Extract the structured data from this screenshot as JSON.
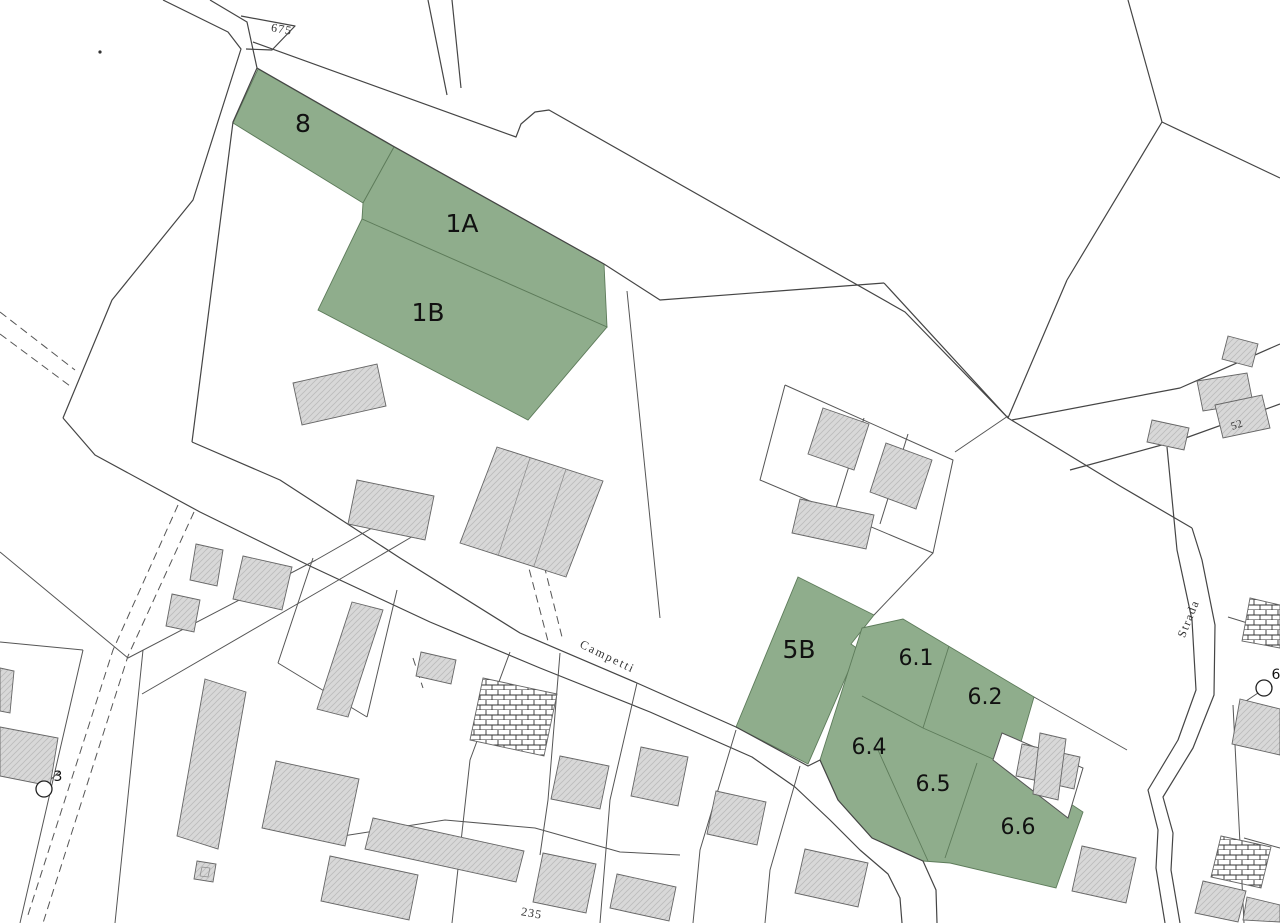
{
  "map": {
    "type": "cadastral-parcel-map",
    "background": "#ffffff",
    "colors": {
      "parcel_green": "#8FAD8C",
      "parcel_green_stroke": "#5d7b5a",
      "line": "#454545",
      "boundary": "#555555",
      "building_fill": "#d8d8d8",
      "building_hatch": "#bcbcbc",
      "building_stroke": "#666666",
      "brick_line": "#333333",
      "label": "#111111",
      "road_label": "#333333"
    },
    "green_parcels": [
      {
        "id": "8",
        "points": "233,123 258,69 394,147 363,203"
      },
      {
        "id": "1A",
        "points": "363,203 394,147 604,264 607,327 362,219"
      },
      {
        "id": "1B",
        "points": "362,219 607,327 528,420 318,310"
      },
      {
        "id": "5B",
        "points": "798,577 874,615 851,644 858,649 808,764 736,727"
      },
      {
        "id": "6-block",
        "points": "862,628 903,619 1034,697 1014,766 1021,771 1083,812 1056,888 950,863 923,861 872,838 838,800 820,760"
      }
    ],
    "cutouts": [
      {
        "id": "6-cutout",
        "points": "1002,733 1083,768 1068,818 993,760"
      }
    ],
    "green_dividers": [
      {
        "points": "949,646 923,728"
      },
      {
        "points": "862,696 923,728 993,759"
      },
      {
        "points": "878,750 928,861"
      },
      {
        "points": "977,763 945,858"
      }
    ],
    "parcel_labels": [
      {
        "text": "8",
        "x": 303,
        "y": 132,
        "fs": 25
      },
      {
        "text": "1A",
        "x": 462,
        "y": 232,
        "fs": 25
      },
      {
        "text": "1B",
        "x": 428,
        "y": 321,
        "fs": 25
      },
      {
        "text": "5B",
        "x": 799,
        "y": 658,
        "fs": 25
      },
      {
        "text": "6.1",
        "x": 916,
        "y": 665,
        "fs": 22
      },
      {
        "text": "6.2",
        "x": 985,
        "y": 704,
        "fs": 22
      },
      {
        "text": "6.4",
        "x": 869,
        "y": 754,
        "fs": 22
      },
      {
        "text": "6.5",
        "x": 933,
        "y": 791,
        "fs": 22
      },
      {
        "text": "6.6",
        "x": 1018,
        "y": 834,
        "fs": 22
      }
    ],
    "roads": [
      {
        "name": "left-road-west-edge",
        "points": "163,0 228,32 241,49 193,200 112,300 63,418"
      },
      {
        "name": "left-road-east-edge",
        "points": "210,0 247,22 257,68 233,122 192,442"
      },
      {
        "name": "wedge-675",
        "points": "241,16 295,26 272,50 246,49"
      },
      {
        "name": "main-road-upper-edge",
        "points": "253,42 516,137 521,124 535,112 549,110 905,312 1008,418 1120,486 1192,528"
      },
      {
        "name": "main-road-lower-edge",
        "points": "257,68 393,146 604,264"
      },
      {
        "name": "center-parcel-top",
        "points": "604,264 660,300 884,283"
      },
      {
        "name": "v-junction-left",
        "points": "884,283 1008,418"
      },
      {
        "name": "v-junction-right",
        "points": "1067,280 1008,418"
      },
      {
        "name": "campetti-north-edge",
        "points": "192,442 280,480 400,558 520,633 637,683 736,727 808,766 820,760 838,800 872,838 923,861 936,890 937,923"
      },
      {
        "name": "campetti-south-edge",
        "points": "63,418 95,455 200,512 310,566 430,622 540,668 650,712 752,757 795,787 830,820 860,850 888,874 900,898 902,923"
      },
      {
        "name": "strada-west-edge",
        "points": "1167,447 1177,550 1192,620 1196,690 1178,740 1148,790 1158,830 1156,868 1165,923"
      },
      {
        "name": "strada-east-edge",
        "points": "1192,528 1202,560 1215,625 1214,695 1193,748 1163,797 1173,833 1171,870 1180,923"
      },
      {
        "name": "ne-road-upper-edge",
        "points": "1012,420 1180,388 1280,344"
      },
      {
        "name": "ne-road-lower-edge",
        "points": "1070,470 1180,440 1280,404"
      },
      {
        "name": "top-branch-left",
        "points": "428,0 447,95"
      },
      {
        "name": "top-branch-right",
        "points": "452,0 461,88"
      },
      {
        "name": "topright-line-1",
        "points": "1128,0 1162,122"
      },
      {
        "name": "topright-line-2",
        "points": "1162,122 1280,178"
      },
      {
        "name": "topright-line-3",
        "points": "1162,122 1067,280"
      }
    ],
    "boundaries": [
      {
        "points": "627,291 660,618"
      },
      {
        "points": "874,615 933,553"
      },
      {
        "points": "785,385 953,460 933,553 760,480 785,385"
      },
      {
        "points": "864,418 836,508"
      },
      {
        "points": "908,434 880,524"
      },
      {
        "points": "955,452 1008,416"
      },
      {
        "points": "1034,697 1127,750"
      },
      {
        "points": "83,650 20,923"
      },
      {
        "points": "0,642 83,650"
      },
      {
        "points": "143,650 115,923"
      },
      {
        "points": "0,552 128,658"
      },
      {
        "points": "128,658 316,560 400,512"
      },
      {
        "points": "142,694 330,585 415,535"
      },
      {
        "points": "313,558 278,663"
      },
      {
        "points": "397,590 367,717"
      },
      {
        "points": "278,663 367,717"
      },
      {
        "points": "510,652 470,760 452,923"
      },
      {
        "points": "560,653 548,800 540,855"
      },
      {
        "points": "637,683 610,800 600,923"
      },
      {
        "points": "736,730 700,850 693,923"
      },
      {
        "points": "800,766 770,870 765,923"
      },
      {
        "points": "330,838 445,820 535,828 620,852 680,855"
      },
      {
        "points": "1228,617 1280,633"
      },
      {
        "points": "1233,705 1244,923"
      },
      {
        "points": "1244,838 1280,848"
      },
      {
        "points": "48,782 60,771"
      },
      {
        "points": "1258,693 1246,701"
      }
    ],
    "dashed_paths": [
      {
        "points": "0,312 75,370"
      },
      {
        "points": "0,334 70,386"
      },
      {
        "points": "178,505 113,650 27,918"
      },
      {
        "points": "194,512 128,656 43,923"
      },
      {
        "points": "526,557 549,645"
      },
      {
        "points": "541,553 563,641"
      },
      {
        "points": "413,658 423,688"
      }
    ],
    "buildings": [
      {
        "points": "293,383 377,364 386,406 302,425",
        "style": "hatch"
      },
      {
        "points": "357,480 434,496 425,540 348,524",
        "style": "hatch"
      },
      {
        "points": "497,447 603,481 566,577 460,543",
        "style": "hatch"
      },
      {
        "points": "823,408 869,424 854,470 808,454",
        "style": "hatch"
      },
      {
        "points": "886,443 932,460 916,509 870,492",
        "style": "hatch"
      },
      {
        "points": "800,499 874,515 866,549 792,533",
        "style": "hatch"
      },
      {
        "points": "1228,336 1258,344 1252,367 1222,359",
        "style": "hatch"
      },
      {
        "points": "1197,381 1247,373 1253,403 1203,411",
        "style": "hatch"
      },
      {
        "points": "1215,405 1262,395 1270,428 1223,438",
        "style": "hatch"
      },
      {
        "points": "1152,420 1189,428 1184,450 1147,442",
        "style": "hatch"
      },
      {
        "points": "0,668 14,671 10,713 0,711",
        "style": "hatch"
      },
      {
        "points": "0,727 58,738 50,786 0,776",
        "style": "hatch"
      },
      {
        "points": "205,679 246,692 218,849 177,836",
        "style": "hatch"
      },
      {
        "points": "196,544 223,550 217,586 190,580",
        "style": "hatch"
      },
      {
        "points": "243,556 292,567 282,610 233,599",
        "style": "hatch"
      },
      {
        "points": "172,594 200,600 194,632 166,626",
        "style": "hatch"
      },
      {
        "points": "276,761 359,779 345,846 262,828",
        "style": "hatch"
      },
      {
        "points": "330,856 418,875 409,920 321,901",
        "style": "hatch"
      },
      {
        "points": "373,818 524,851 516,882 365,849",
        "style": "hatch"
      },
      {
        "points": "421,652 456,660 451,684 416,676",
        "style": "hatch"
      },
      {
        "points": "483,678 557,694 544,756 470,740",
        "style": "brick"
      },
      {
        "points": "560,756 609,766 600,809 551,799",
        "style": "hatch"
      },
      {
        "points": "641,747 688,757 678,806 631,796",
        "style": "hatch"
      },
      {
        "points": "716,791 766,802 757,845 707,834",
        "style": "hatch"
      },
      {
        "points": "543,853 596,864 586,913 533,902",
        "style": "hatch"
      },
      {
        "points": "617,874 676,887 669,921 610,908",
        "style": "hatch"
      },
      {
        "points": "805,849 868,863 858,907 795,893",
        "style": "hatch"
      },
      {
        "points": "1022,744 1080,757 1074,789 1016,776",
        "style": "hatch"
      },
      {
        "points": "1040,733 1066,739 1058,800 1033,794",
        "style": "hatch"
      },
      {
        "points": "1082,846 1136,858 1126,903 1072,891",
        "style": "hatch"
      },
      {
        "points": "1221,836 1271,847 1261,888 1211,877",
        "style": "brick"
      },
      {
        "points": "1203,881 1246,891 1238,922 1195,913",
        "style": "hatch"
      },
      {
        "points": "1247,897 1280,905 1280,922 1243,920",
        "style": "hatch"
      },
      {
        "points": "1240,699 1280,709 1280,755 1232,744",
        "style": "hatch"
      },
      {
        "points": "1250,598 1280,605 1280,648 1242,641",
        "style": "brick"
      },
      {
        "points": "352,602 383,610 348,717 317,709",
        "style": "hatch"
      },
      {
        "points": "197,861 216,864 213,882 194,879",
        "style": "hatch"
      }
    ],
    "building_inner_lines": [
      {
        "points": "530,458 498,556"
      },
      {
        "points": "566,469 534,566"
      },
      {
        "points": "202,867 210,868 208,877 200,876 202,867"
      }
    ],
    "markers": [
      {
        "label": "3",
        "cx": 44,
        "cy": 789,
        "r": 8,
        "lx": 58,
        "ly": 781,
        "fs": 14
      },
      {
        "label": "6",
        "cx": 1264,
        "cy": 688,
        "r": 8,
        "lx": 1276,
        "ly": 679,
        "fs": 14
      }
    ],
    "dots": [
      {
        "cx": 100,
        "cy": 52,
        "r": 1.6
      }
    ],
    "text_labels": [
      {
        "text": "675",
        "x": 281,
        "y": 33,
        "rot": 10,
        "fs": 12,
        "ls": 1
      },
      {
        "text": "Campetti",
        "x": 606,
        "y": 660,
        "rot": 26,
        "fs": 12,
        "ls": 2
      },
      {
        "text": "Strada",
        "x": 1192,
        "y": 620,
        "rot": -68,
        "fs": 12,
        "ls": 1.5
      },
      {
        "text": "52",
        "x": 1238,
        "y": 428,
        "rot": -20,
        "fs": 11,
        "ls": 0.5
      },
      {
        "text": "235",
        "x": 531,
        "y": 917,
        "rot": 10,
        "fs": 12,
        "ls": 1
      }
    ]
  }
}
